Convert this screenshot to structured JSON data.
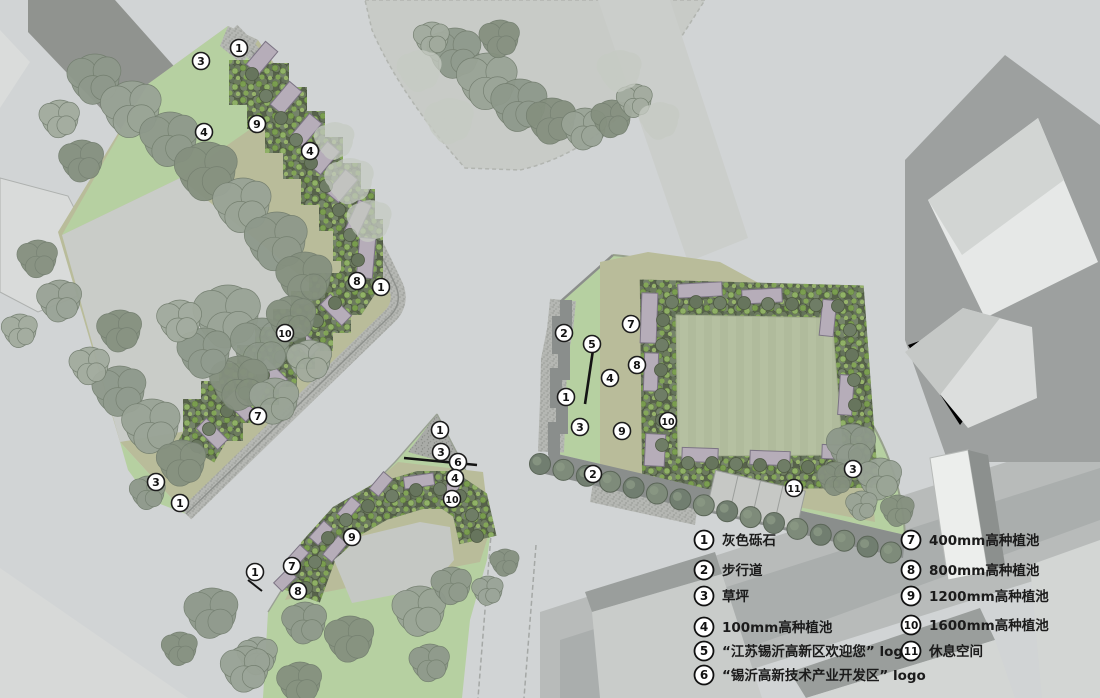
{
  "plan": {
    "type": "landscape-site-plan",
    "legend": {
      "columns": [
        {
          "circle_x": 704,
          "text_x": 722,
          "items": [
            {
              "n": "1",
              "y": 540,
              "label": "灰色砾石"
            },
            {
              "n": "2",
              "y": 570,
              "label": "步行道"
            },
            {
              "n": "3",
              "y": 596,
              "label": "草坪"
            },
            {
              "n": "4",
              "y": 627,
              "label": "100mm高种植池"
            },
            {
              "n": "5",
              "y": 651,
              "label": "“江苏锡沂高新区欢迎您” logo"
            },
            {
              "n": "6",
              "y": 675,
              "label": "“锡沂高新技术产业开发区” logo"
            }
          ]
        },
        {
          "circle_x": 911,
          "text_x": 929,
          "items": [
            {
              "n": "7",
              "y": 540,
              "label": "400mm高种植池"
            },
            {
              "n": "8",
              "y": 570,
              "label": "800mm高种植池"
            },
            {
              "n": "9",
              "y": 596,
              "label": "1200mm高种植池"
            },
            {
              "n": "10",
              "y": 625,
              "label": "1600mm高种植池"
            },
            {
              "n": "11",
              "y": 651,
              "label": "休息空间"
            }
          ]
        }
      ]
    },
    "markers": [
      {
        "n": "1",
        "x": 239,
        "y": 48
      },
      {
        "n": "3",
        "x": 201,
        "y": 61
      },
      {
        "n": "4",
        "x": 204,
        "y": 132
      },
      {
        "n": "9",
        "x": 257,
        "y": 124
      },
      {
        "n": "4",
        "x": 310,
        "y": 151
      },
      {
        "n": "8",
        "x": 357,
        "y": 281
      },
      {
        "n": "1",
        "x": 381,
        "y": 287
      },
      {
        "n": "10",
        "x": 285,
        "y": 333
      },
      {
        "n": "7",
        "x": 258,
        "y": 416
      },
      {
        "n": "3",
        "x": 156,
        "y": 482
      },
      {
        "n": "1",
        "x": 180,
        "y": 503
      },
      {
        "n": "1",
        "x": 440,
        "y": 430
      },
      {
        "n": "3",
        "x": 441,
        "y": 452
      },
      {
        "n": "6",
        "x": 458,
        "y": 462
      },
      {
        "n": "4",
        "x": 455,
        "y": 478
      },
      {
        "n": "10",
        "x": 452,
        "y": 499
      },
      {
        "n": "9",
        "x": 352,
        "y": 537
      },
      {
        "n": "7",
        "x": 292,
        "y": 566
      },
      {
        "n": "8",
        "x": 298,
        "y": 591
      },
      {
        "n": "1",
        "x": 255,
        "y": 572
      },
      {
        "n": "2",
        "x": 564,
        "y": 333
      },
      {
        "n": "5",
        "x": 592,
        "y": 344
      },
      {
        "n": "7",
        "x": 631,
        "y": 324
      },
      {
        "n": "8",
        "x": 637,
        "y": 365
      },
      {
        "n": "4",
        "x": 610,
        "y": 378
      },
      {
        "n": "1",
        "x": 566,
        "y": 397
      },
      {
        "n": "3",
        "x": 580,
        "y": 427
      },
      {
        "n": "9",
        "x": 622,
        "y": 431
      },
      {
        "n": "10",
        "x": 668,
        "y": 421
      },
      {
        "n": "2",
        "x": 593,
        "y": 474
      },
      {
        "n": "11",
        "x": 794,
        "y": 488
      },
      {
        "n": "3",
        "x": 853,
        "y": 469
      }
    ],
    "palette": {
      "road_base": "#d1d4d5",
      "plaza": "#c8cbc7",
      "road_band": "#b8bbba",
      "roadway": "#aaaead",
      "walk_dark": "#8a8e8c",
      "gravel": "#b5b7b3",
      "lawn": "#b6d0a1",
      "lawn_muted": "#b5c0a1",
      "olive": "#b9bc9a",
      "bed": "#57624b",
      "shrub": "#7ca24e",
      "planter": "#b6adb9",
      "tree": "#8e998b",
      "tree_dark": "#717e70",
      "building": "#9da09f",
      "building_light": "#dcdedd",
      "marker_bg": "#ffffff",
      "ink": "#1b1b1b"
    }
  }
}
